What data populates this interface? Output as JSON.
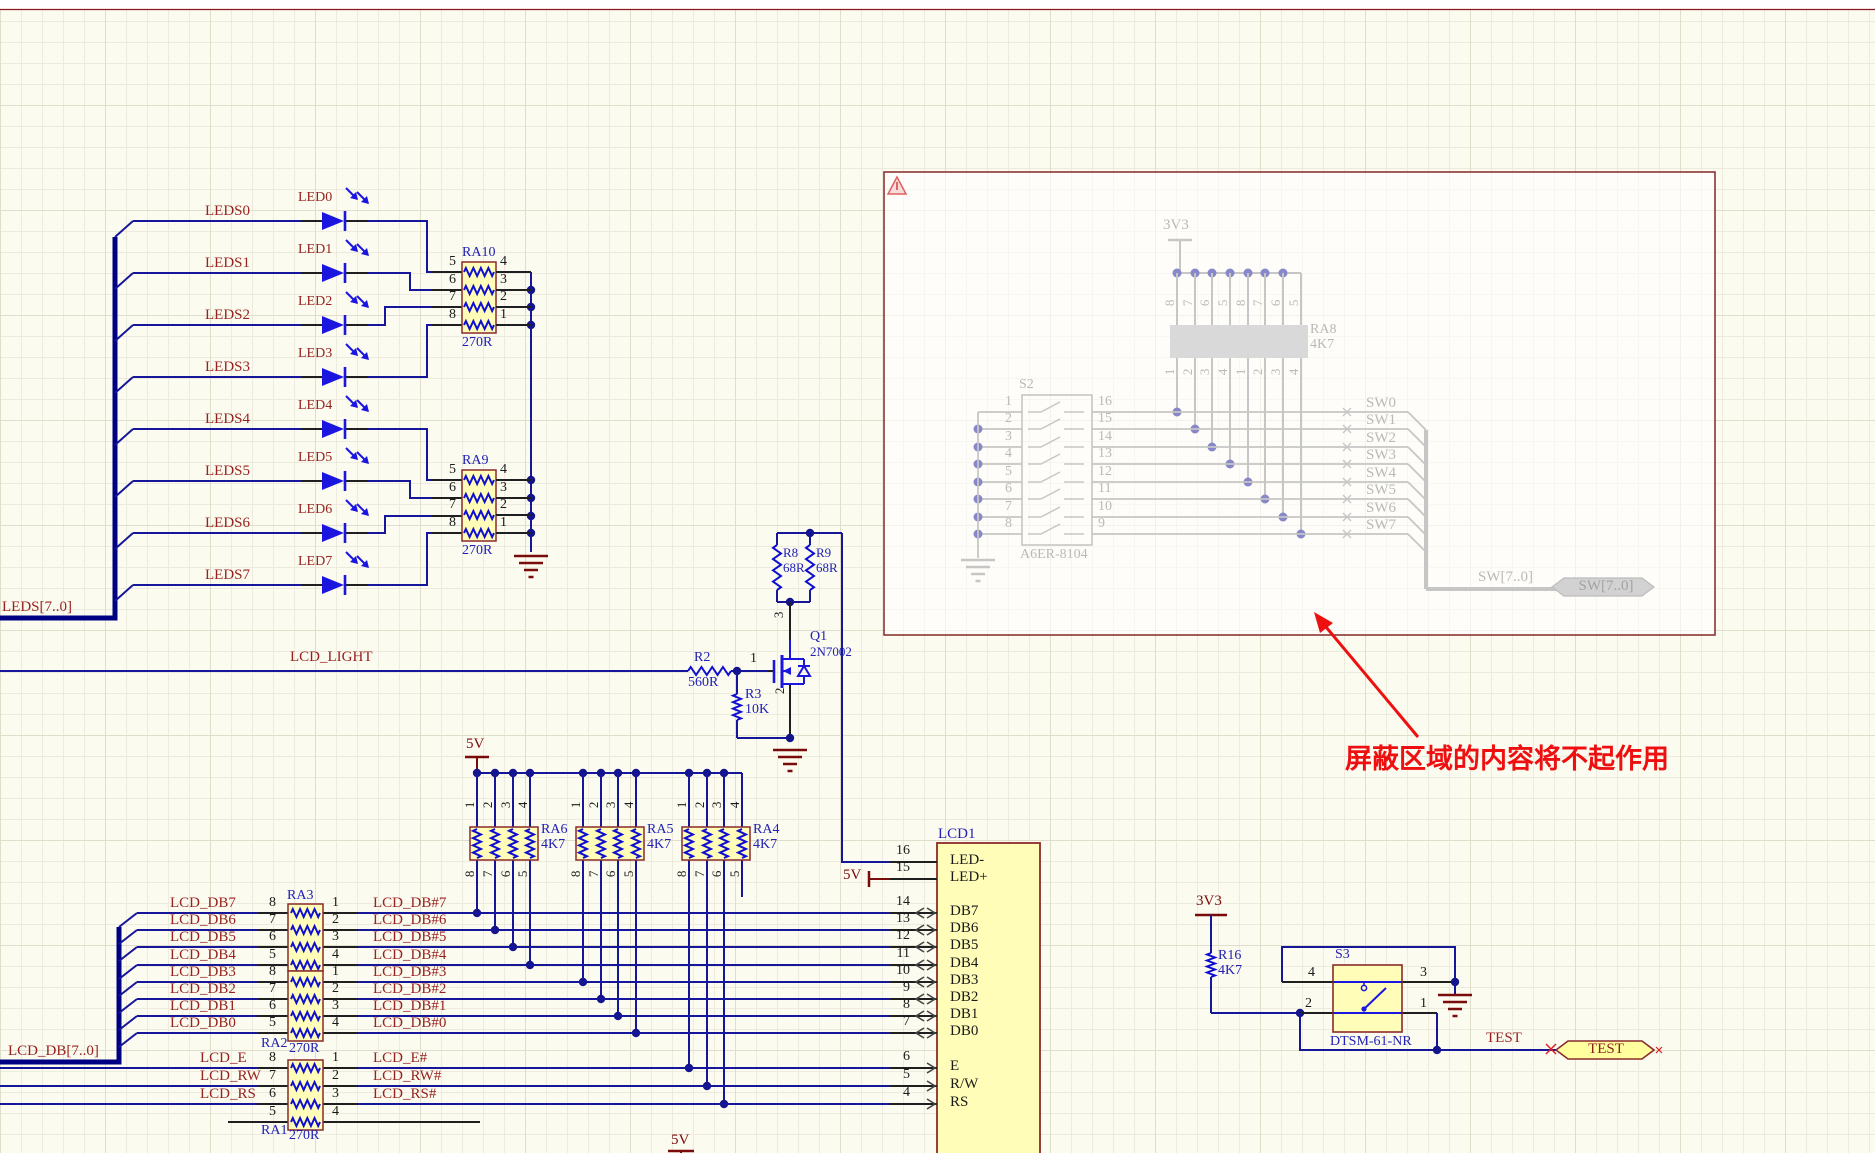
{
  "palette": {
    "wire": "#16169b",
    "bus": "#000082",
    "pin_line": "#1f1f1f",
    "component_fill": "#fffdb8",
    "component_border": "#8a2b2b",
    "net_label": "#97231f",
    "designator": "#2121b4",
    "power": "#7a0b0b",
    "led_blue": "#1a16e0",
    "resistor_blue": "#0f0fcf",
    "junction": "#14148c",
    "masked_line": "#c6c6c6",
    "masked_text": "#b9b9b9",
    "masked_dot": "#8787c9",
    "masked_border": "#8c3434",
    "annotation_red": "#ee1010",
    "sheet_edge": "#8c1a1a"
  },
  "led_array": {
    "bus_label": "LEDS[7..0]",
    "rows": [
      {
        "net": "LEDS0",
        "led": "LED0"
      },
      {
        "net": "LEDS1",
        "led": "LED1"
      },
      {
        "net": "LEDS2",
        "led": "LED2"
      },
      {
        "net": "LEDS3",
        "led": "LED3"
      },
      {
        "net": "LEDS4",
        "led": "LED4"
      },
      {
        "net": "LEDS5",
        "led": "LED5"
      },
      {
        "net": "LEDS6",
        "led": "LED6"
      },
      {
        "net": "LEDS7",
        "led": "LED7"
      }
    ],
    "networks": [
      {
        "designator": "RA10",
        "value": "270R",
        "left_pins": [
          "5",
          "6",
          "7",
          "8"
        ],
        "right_pins": [
          "4",
          "3",
          "2",
          "1"
        ]
      },
      {
        "designator": "RA9",
        "value": "270R",
        "left_pins": [
          "5",
          "6",
          "7",
          "8"
        ],
        "right_pins": [
          "4",
          "3",
          "2",
          "1"
        ]
      }
    ]
  },
  "backlight": {
    "net": "LCD_LIGHT",
    "r2_designator": "R2",
    "r2_value": "560R",
    "r3_designator": "R3",
    "r3_value": "10K",
    "r8_designator": "R8",
    "r8_value": "68R",
    "r9_designator": "R9",
    "r9_value": "68R",
    "q1_designator": "Q1",
    "q1_value": "2N7002",
    "q1_pins": [
      "1",
      "2",
      "3"
    ]
  },
  "pullups": {
    "power": "5V",
    "top_pins": [
      "1",
      "2",
      "3",
      "4"
    ],
    "bottom_pins": [
      "8",
      "7",
      "6",
      "5"
    ],
    "networks": [
      {
        "designator": "RA6",
        "value": "4K7"
      },
      {
        "designator": "RA5",
        "value": "4K7"
      },
      {
        "designator": "RA4",
        "value": "4K7"
      }
    ]
  },
  "lcd_bus": {
    "bus_label": "LCD_DB[7..0]",
    "rows": [
      {
        "net": "LCD_DB7",
        "left_pin": "8",
        "right_pin": "1",
        "out_net": "LCD_DB#7"
      },
      {
        "net": "LCD_DB6",
        "left_pin": "7",
        "right_pin": "2",
        "out_net": "LCD_DB#6"
      },
      {
        "net": "LCD_DB5",
        "left_pin": "6",
        "right_pin": "3",
        "out_net": "LCD_DB#5"
      },
      {
        "net": "LCD_DB4",
        "left_pin": "5",
        "right_pin": "4",
        "out_net": "LCD_DB#4"
      },
      {
        "net": "LCD_DB3",
        "left_pin": "8",
        "right_pin": "1",
        "out_net": "LCD_DB#3"
      },
      {
        "net": "LCD_DB2",
        "left_pin": "7",
        "right_pin": "2",
        "out_net": "LCD_DB#2"
      },
      {
        "net": "LCD_DB1",
        "left_pin": "6",
        "right_pin": "3",
        "out_net": "LCD_DB#1"
      },
      {
        "net": "LCD_DB0",
        "left_pin": "5",
        "right_pin": "4",
        "out_net": "LCD_DB#0"
      },
      {
        "net": "LCD_E",
        "left_pin": "8",
        "right_pin": "1",
        "out_net": "LCD_E#"
      },
      {
        "net": "LCD_RW",
        "left_pin": "7",
        "right_pin": "2",
        "out_net": "LCD_RW#"
      },
      {
        "net": "LCD_RS",
        "left_pin": "6",
        "right_pin": "3",
        "out_net": "LCD_RS#"
      },
      {
        "net": "",
        "left_pin": "5",
        "right_pin": "4",
        "out_net": ""
      }
    ],
    "networks": [
      {
        "designator": "RA3",
        "value": ""
      },
      {
        "designator": "RA2",
        "value": "270R"
      },
      {
        "designator": "RA1",
        "value": "270R"
      }
    ]
  },
  "lcd": {
    "designator": "LCD1",
    "backlight_power": "5V",
    "pins": [
      {
        "num": "16",
        "name": "LED-"
      },
      {
        "num": "15",
        "name": "LED+"
      },
      {
        "num": "14",
        "name": "DB7"
      },
      {
        "num": "13",
        "name": "DB6"
      },
      {
        "num": "12",
        "name": "DB5"
      },
      {
        "num": "11",
        "name": "DB4"
      },
      {
        "num": "10",
        "name": "DB3"
      },
      {
        "num": "9",
        "name": "DB2"
      },
      {
        "num": "8",
        "name": "DB1"
      },
      {
        "num": "7",
        "name": "DB0"
      },
      {
        "num": "6",
        "name": "E"
      },
      {
        "num": "5",
        "name": "R/W"
      },
      {
        "num": "4",
        "name": "RS"
      }
    ]
  },
  "bottom_power": "5V",
  "masked_region": {
    "power": "3V3",
    "resnet": {
      "designator": "RA8",
      "value": "4K7",
      "top_pins": [
        "8",
        "7",
        "6",
        "5",
        "8",
        "7",
        "6",
        "5"
      ],
      "bottom_pins": [
        "1",
        "2",
        "3",
        "4",
        "1",
        "2",
        "3",
        "4"
      ]
    },
    "switch": {
      "designator": "S2",
      "value": "A6ER-8104",
      "left_pins": [
        "1",
        "2",
        "3",
        "4",
        "5",
        "6",
        "7",
        "8"
      ],
      "right_pins": [
        "16",
        "15",
        "14",
        "13",
        "12",
        "11",
        "10",
        "9"
      ]
    },
    "sw_nets": [
      "SW0",
      "SW1",
      "SW2",
      "SW3",
      "SW4",
      "SW5",
      "SW6",
      "SW7"
    ],
    "bus_net": "SW[7..0]",
    "port_label": "SW[7..0]"
  },
  "annotation": {
    "text": "屏蔽区域的内容将不起作用"
  },
  "test_circuit": {
    "power": "3V3",
    "r16_designator": "R16",
    "r16_value": "4K7",
    "switch_designator": "S3",
    "switch_value": "DTSM-61-NR",
    "switch_pins": [
      "4",
      "3",
      "2",
      "1"
    ],
    "net": "TEST",
    "port_label": "TEST"
  }
}
